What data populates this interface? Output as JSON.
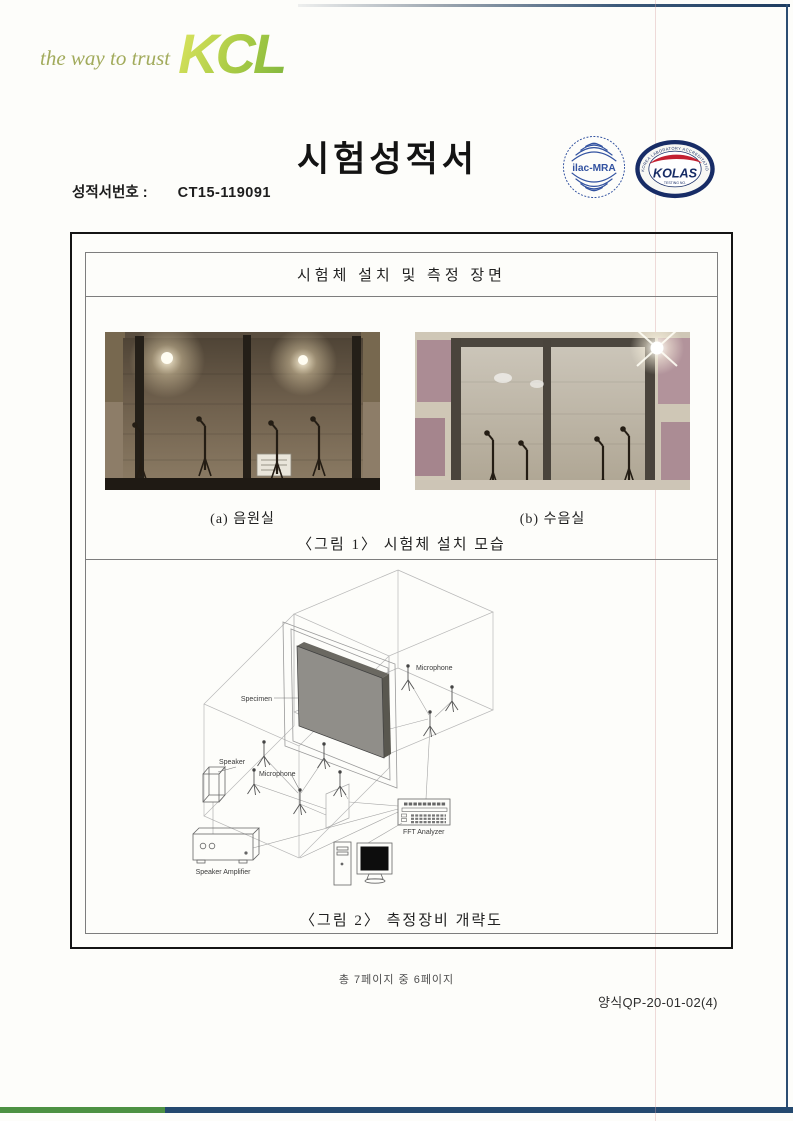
{
  "colors": {
    "accent_navy": "#24496f",
    "accent_green": "#4d9143",
    "logo_green": "#a9c84b",
    "kolas_navy": "#172c66",
    "kolas_red": "#c32031",
    "ilac_blue": "#3252a0"
  },
  "header": {
    "tagline": "the way to trust",
    "logo": "KCL",
    "title": "시험성적서",
    "report_no_label": "성적서번호 :",
    "report_no_value": "CT15-119091",
    "ilac_logo_text": "ilac-MRA",
    "kolas_logo_text": "KOLAS",
    "kolas_ring_text": "KOREA LABORATORY ACCREDITATION SCHEME",
    "kolas_sub_text": "TESTING NO."
  },
  "main": {
    "section_title": "시험체 설치 및 측정 장면",
    "figure1": {
      "caption_a": "(a) 음원실",
      "caption_b": "(b) 수음실",
      "caption": "〈그림 1〉 시험체 설치 모습"
    },
    "figure2": {
      "caption": "〈그림 2〉 측정장비 개략도",
      "labels": {
        "specimen": "Specimen",
        "microphone_receiving": "Microphone",
        "microphone_source": "Microphone",
        "speaker": "Speaker",
        "speaker_amplifier": "Speaker Amplifier",
        "fft_analyzer": "FFT Analyzer"
      }
    }
  },
  "footer": {
    "page_info": "총 7페이지 중 6페이지",
    "form_no": "양식QP-20-01-02(4)"
  }
}
